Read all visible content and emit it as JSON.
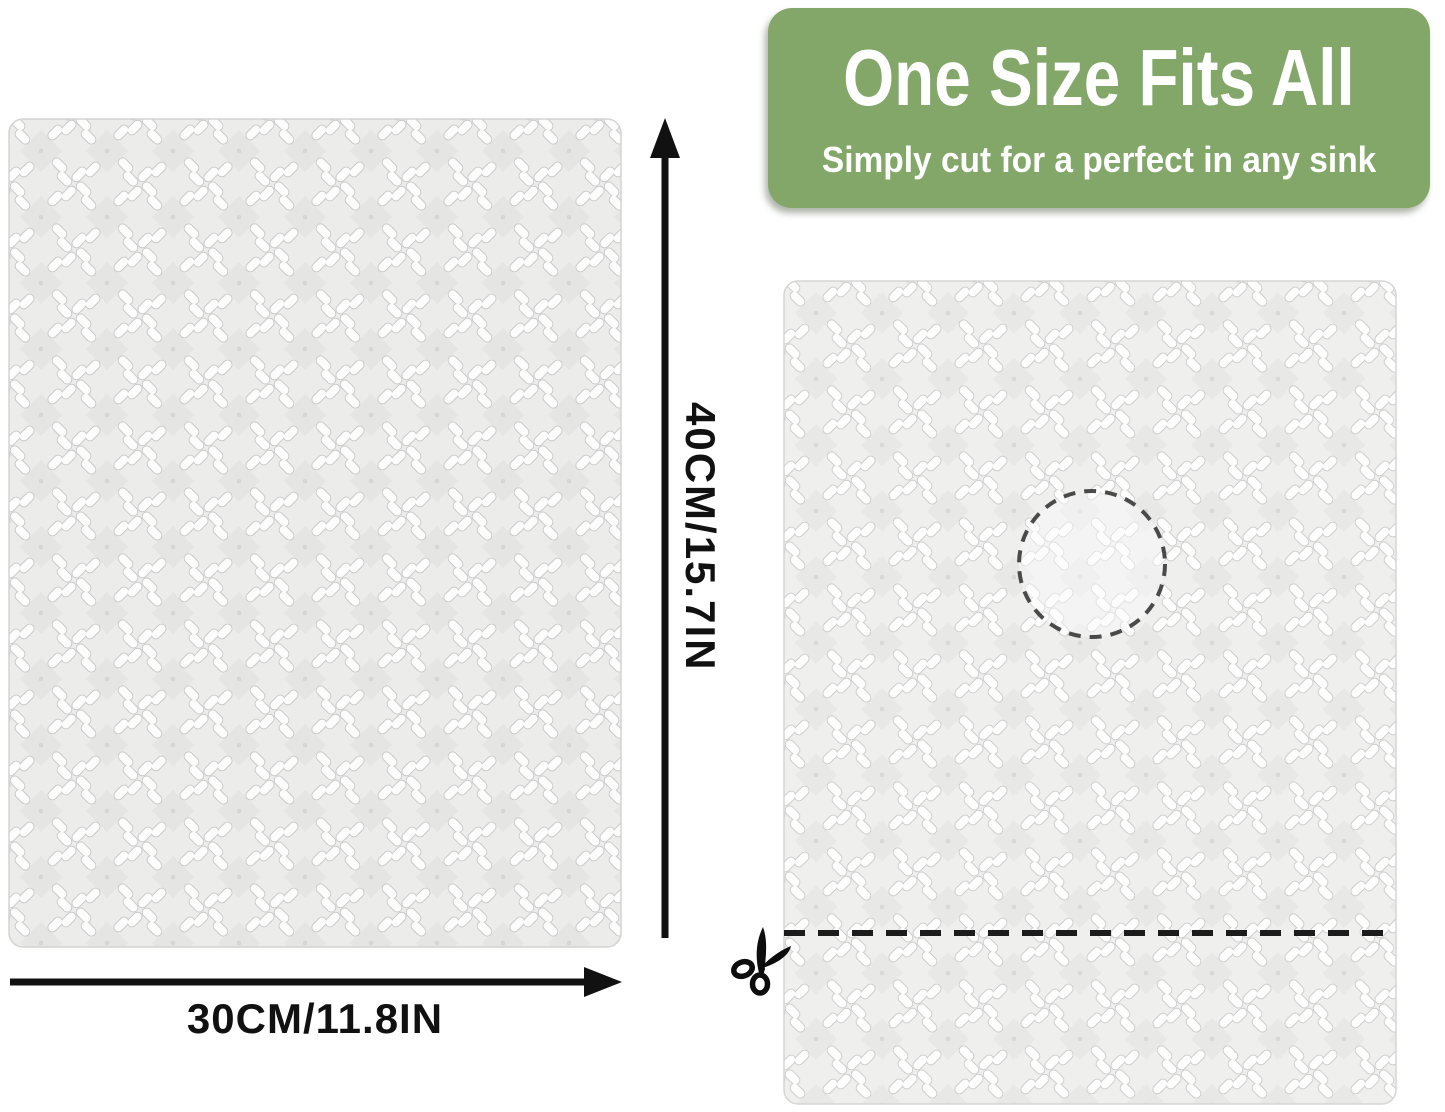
{
  "banner": {
    "title": "One Size Fits All",
    "subtitle": "Simply cut for a perfect in any sink",
    "bg_color": "#82a768",
    "text_color": "#ffffff"
  },
  "dimensions": {
    "height_label": "40CM/15.7IN",
    "width_label": "30CM/11.8IN",
    "arrow_color": "#111111"
  },
  "mats": {
    "left": {
      "label": "sink mat (30cm x 40cm)"
    },
    "right": {
      "label": "sink mat with drain cutout and cut line"
    }
  },
  "icons": {
    "scissors": "scissors-icon",
    "height_arrow": "up-arrow-icon",
    "width_arrow": "right-arrow-icon",
    "drain_cutout": "dashed-circle",
    "cut_line": "dashed-line"
  },
  "colors": {
    "background": "#ffffff",
    "mat_base": "#ececeb",
    "mat_diamond": "#e5e5e4",
    "mat_petal": "#fcfcfc",
    "petal_outline": "#c8c8c8",
    "cut_line": "#1c1c1c",
    "drain_circle": "#4a4a4a"
  }
}
